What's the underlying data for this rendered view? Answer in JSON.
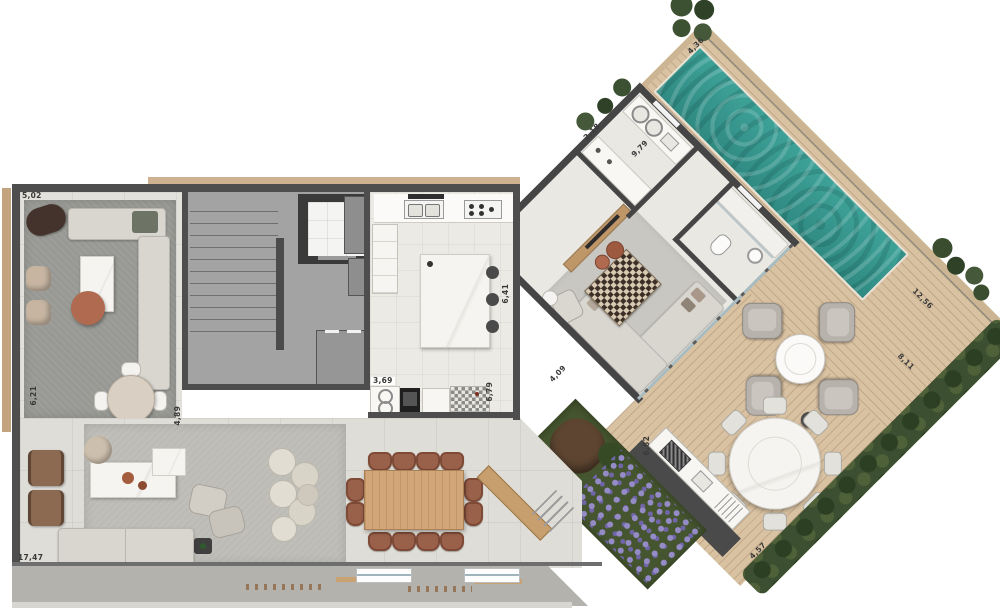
{
  "plan": {
    "title": "penthouse-floor-plan",
    "dimension_labels": [
      {
        "id": "dim-1",
        "text": "5,02"
      },
      {
        "id": "dim-2",
        "text": "6,21"
      },
      {
        "id": "dim-3",
        "text": "17,47"
      },
      {
        "id": "dim-4",
        "text": "4,89"
      },
      {
        "id": "dim-5",
        "text": "3,69"
      },
      {
        "id": "dim-6",
        "text": "6,79"
      },
      {
        "id": "dim-7",
        "text": "6,41"
      },
      {
        "id": "dim-8",
        "text": "4,09"
      },
      {
        "id": "dim-9",
        "text": "2,18"
      },
      {
        "id": "dim-10",
        "text": "9,79"
      },
      {
        "id": "dim-11",
        "text": "4,36"
      },
      {
        "id": "dim-12",
        "text": "12,56"
      },
      {
        "id": "dim-13",
        "text": "8,11"
      },
      {
        "id": "dim-14",
        "text": "6,62"
      },
      {
        "id": "dim-15",
        "text": "4,57"
      }
    ],
    "colors": {
      "wall": "#4e4e4e",
      "wall_dark": "#3a3a3a",
      "floor_light": "#e3e1db",
      "floor_tile": "#eceae4",
      "rug_dark": "#989994",
      "rug_light": "#bcbbb6",
      "concrete": "#a3a3a3",
      "deck_wood": "#d9c2a2",
      "wood_furniture": "#d2a678",
      "pool_water": "#36968d",
      "hedge_green": "#3c4f31",
      "lavender": "#8f85c2",
      "marble": "#f4f3f0",
      "sofa_fabric": "#d9d6d0",
      "leather_chair": "#99604a",
      "copper": "#b06a50"
    }
  }
}
